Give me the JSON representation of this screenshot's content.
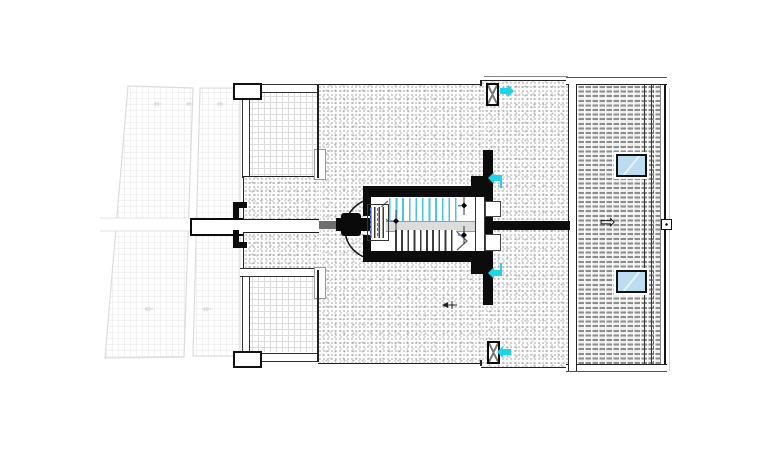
{
  "plan": {
    "type": "architectural roof plan",
    "glyphs": {
      "direction_arrow_right": "⇨",
      "slope_arrow": "↞"
    },
    "colors": {
      "wall_black": "#0c0c0c",
      "cyan_marker": "#1ed5e8",
      "skylight_blue": "#bcdcf0",
      "stair_tread_cyan": "#4cc4dc",
      "grid_gray": "#dcdcdc",
      "stipple_gray": "#8f8f8f",
      "dim_blue": "#4a79d8"
    },
    "counts": {
      "skylights": 2,
      "roof_drains": 2,
      "stair_flights": 2,
      "pergola_panels": 2,
      "terraces": 2
    }
  }
}
